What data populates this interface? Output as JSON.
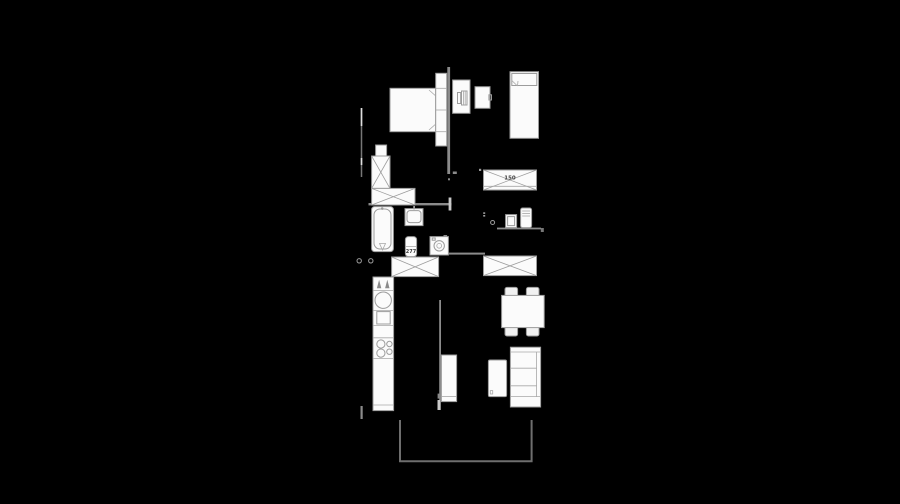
{
  "scene": {
    "type": "apartment-floor-plan-on-black",
    "labels": {
      "hall_wardrobe_size": "150",
      "toilet_model": "277"
    },
    "colors": {
      "background": "#000000",
      "wall": "#8b8b8b",
      "furniture_stroke": "#9c9c9c",
      "furniture_fill": "#fbfbfb",
      "balcony_line": "#6e6e6e",
      "label_text": "#3f3f3f"
    },
    "furniture": [
      "double-bed-with-headboard-and-nightstands",
      "desk-with-chair",
      "small-cabinet",
      "single-bed",
      "hall-wardrobe-150",
      "shelf-with-washbasin-and-boiler",
      "l-shaped-wardrobe",
      "bathtub",
      "bathroom-washbasin",
      "toilet-277",
      "washing-machine",
      "bathroom-wardrobe",
      "living-room-wardrobe",
      "kitchen-counter-with-sink-and-hob",
      "dining-table-with-four-chairs",
      "sofa",
      "coffee-table",
      "tv-sideboard",
      "balcony-railing"
    ]
  }
}
